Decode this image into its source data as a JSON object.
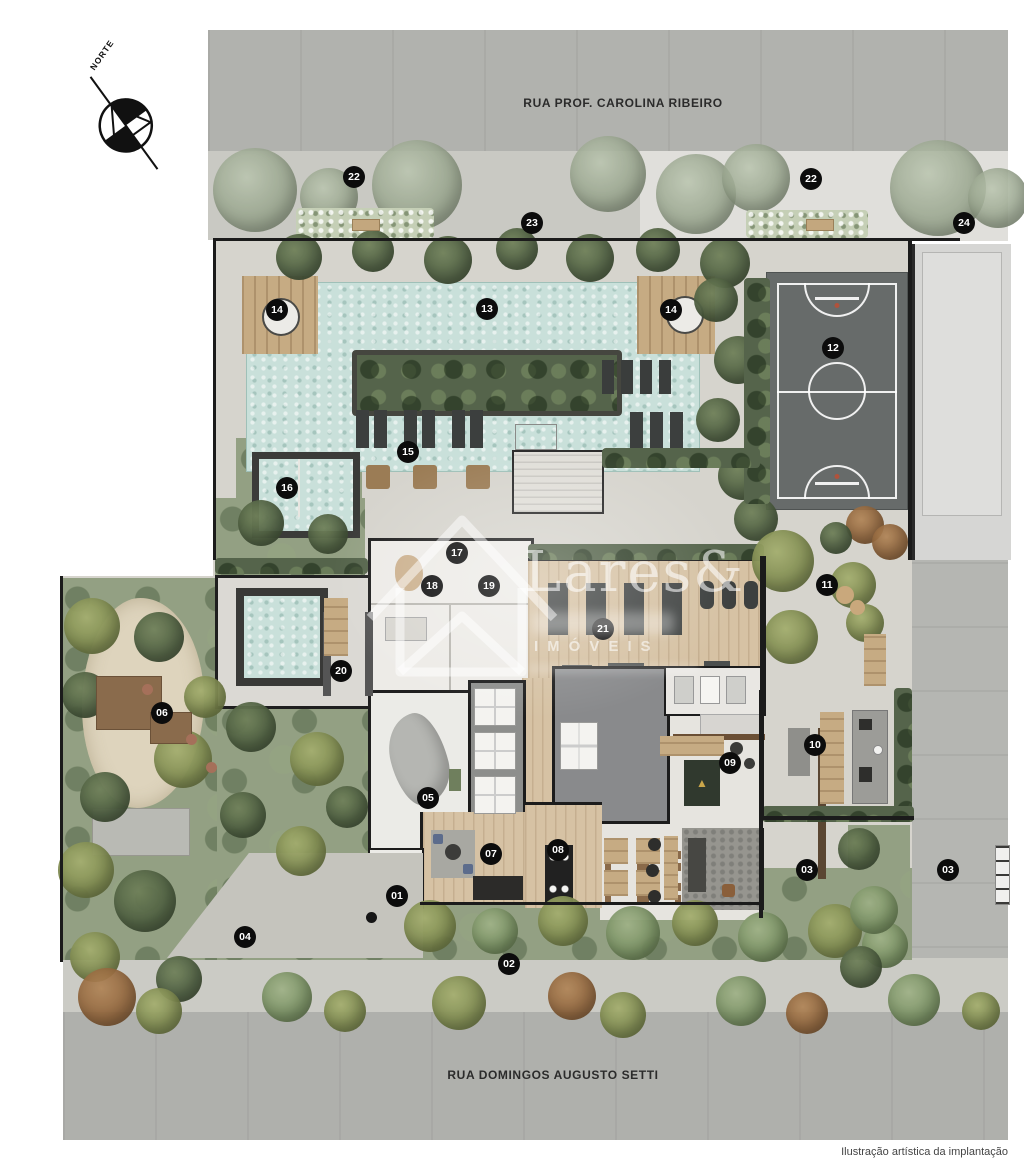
{
  "streets": {
    "top_label": "RUA PROF. CAROLINA RIBEIRO",
    "bottom_label": "RUA DOMINGOS AUGUSTO SETTI"
  },
  "compass": {
    "label": "NORTE"
  },
  "watermark": {
    "brand": "Lares&",
    "category": "IMÓVEIS"
  },
  "caption": "Ilustração artística da implantação",
  "legend_markers": [
    {
      "n": "01",
      "x": 397,
      "y": 896
    },
    {
      "n": "02",
      "x": 509,
      "y": 964
    },
    {
      "n": "03",
      "x": 807,
      "y": 870
    },
    {
      "n": "03",
      "x": 948,
      "y": 870
    },
    {
      "n": "04",
      "x": 245,
      "y": 937
    },
    {
      "n": "05",
      "x": 428,
      "y": 798
    },
    {
      "n": "06",
      "x": 162,
      "y": 713
    },
    {
      "n": "07",
      "x": 491,
      "y": 854
    },
    {
      "n": "08",
      "x": 558,
      "y": 850
    },
    {
      "n": "09",
      "x": 730,
      "y": 763
    },
    {
      "n": "10",
      "x": 815,
      "y": 745
    },
    {
      "n": "11",
      "x": 827,
      "y": 585
    },
    {
      "n": "12",
      "x": 833,
      "y": 348
    },
    {
      "n": "13",
      "x": 487,
      "y": 309
    },
    {
      "n": "14",
      "x": 277,
      "y": 310
    },
    {
      "n": "14",
      "x": 671,
      "y": 310
    },
    {
      "n": "15",
      "x": 408,
      "y": 452
    },
    {
      "n": "16",
      "x": 287,
      "y": 488
    },
    {
      "n": "17",
      "x": 457,
      "y": 553
    },
    {
      "n": "18",
      "x": 432,
      "y": 586
    },
    {
      "n": "19",
      "x": 489,
      "y": 586
    },
    {
      "n": "20",
      "x": 341,
      "y": 671
    },
    {
      "n": "21",
      "x": 603,
      "y": 629
    },
    {
      "n": "22",
      "x": 354,
      "y": 177
    },
    {
      "n": "22",
      "x": 811,
      "y": 179
    },
    {
      "n": "23",
      "x": 532,
      "y": 223
    },
    {
      "n": "24",
      "x": 964,
      "y": 223
    }
  ],
  "colors": {
    "street": "#b1b2ae",
    "sidewalk": "#c9c9c3",
    "ground": "#d6d4cd",
    "pool_water": "#c9e0da",
    "court": "#676b6a",
    "wood_deck": "#c6ab83",
    "hedge": "#55644b",
    "lawn": "#93a083",
    "marker_bg": "#0c0c0c",
    "marker_text": "#ffffff"
  }
}
